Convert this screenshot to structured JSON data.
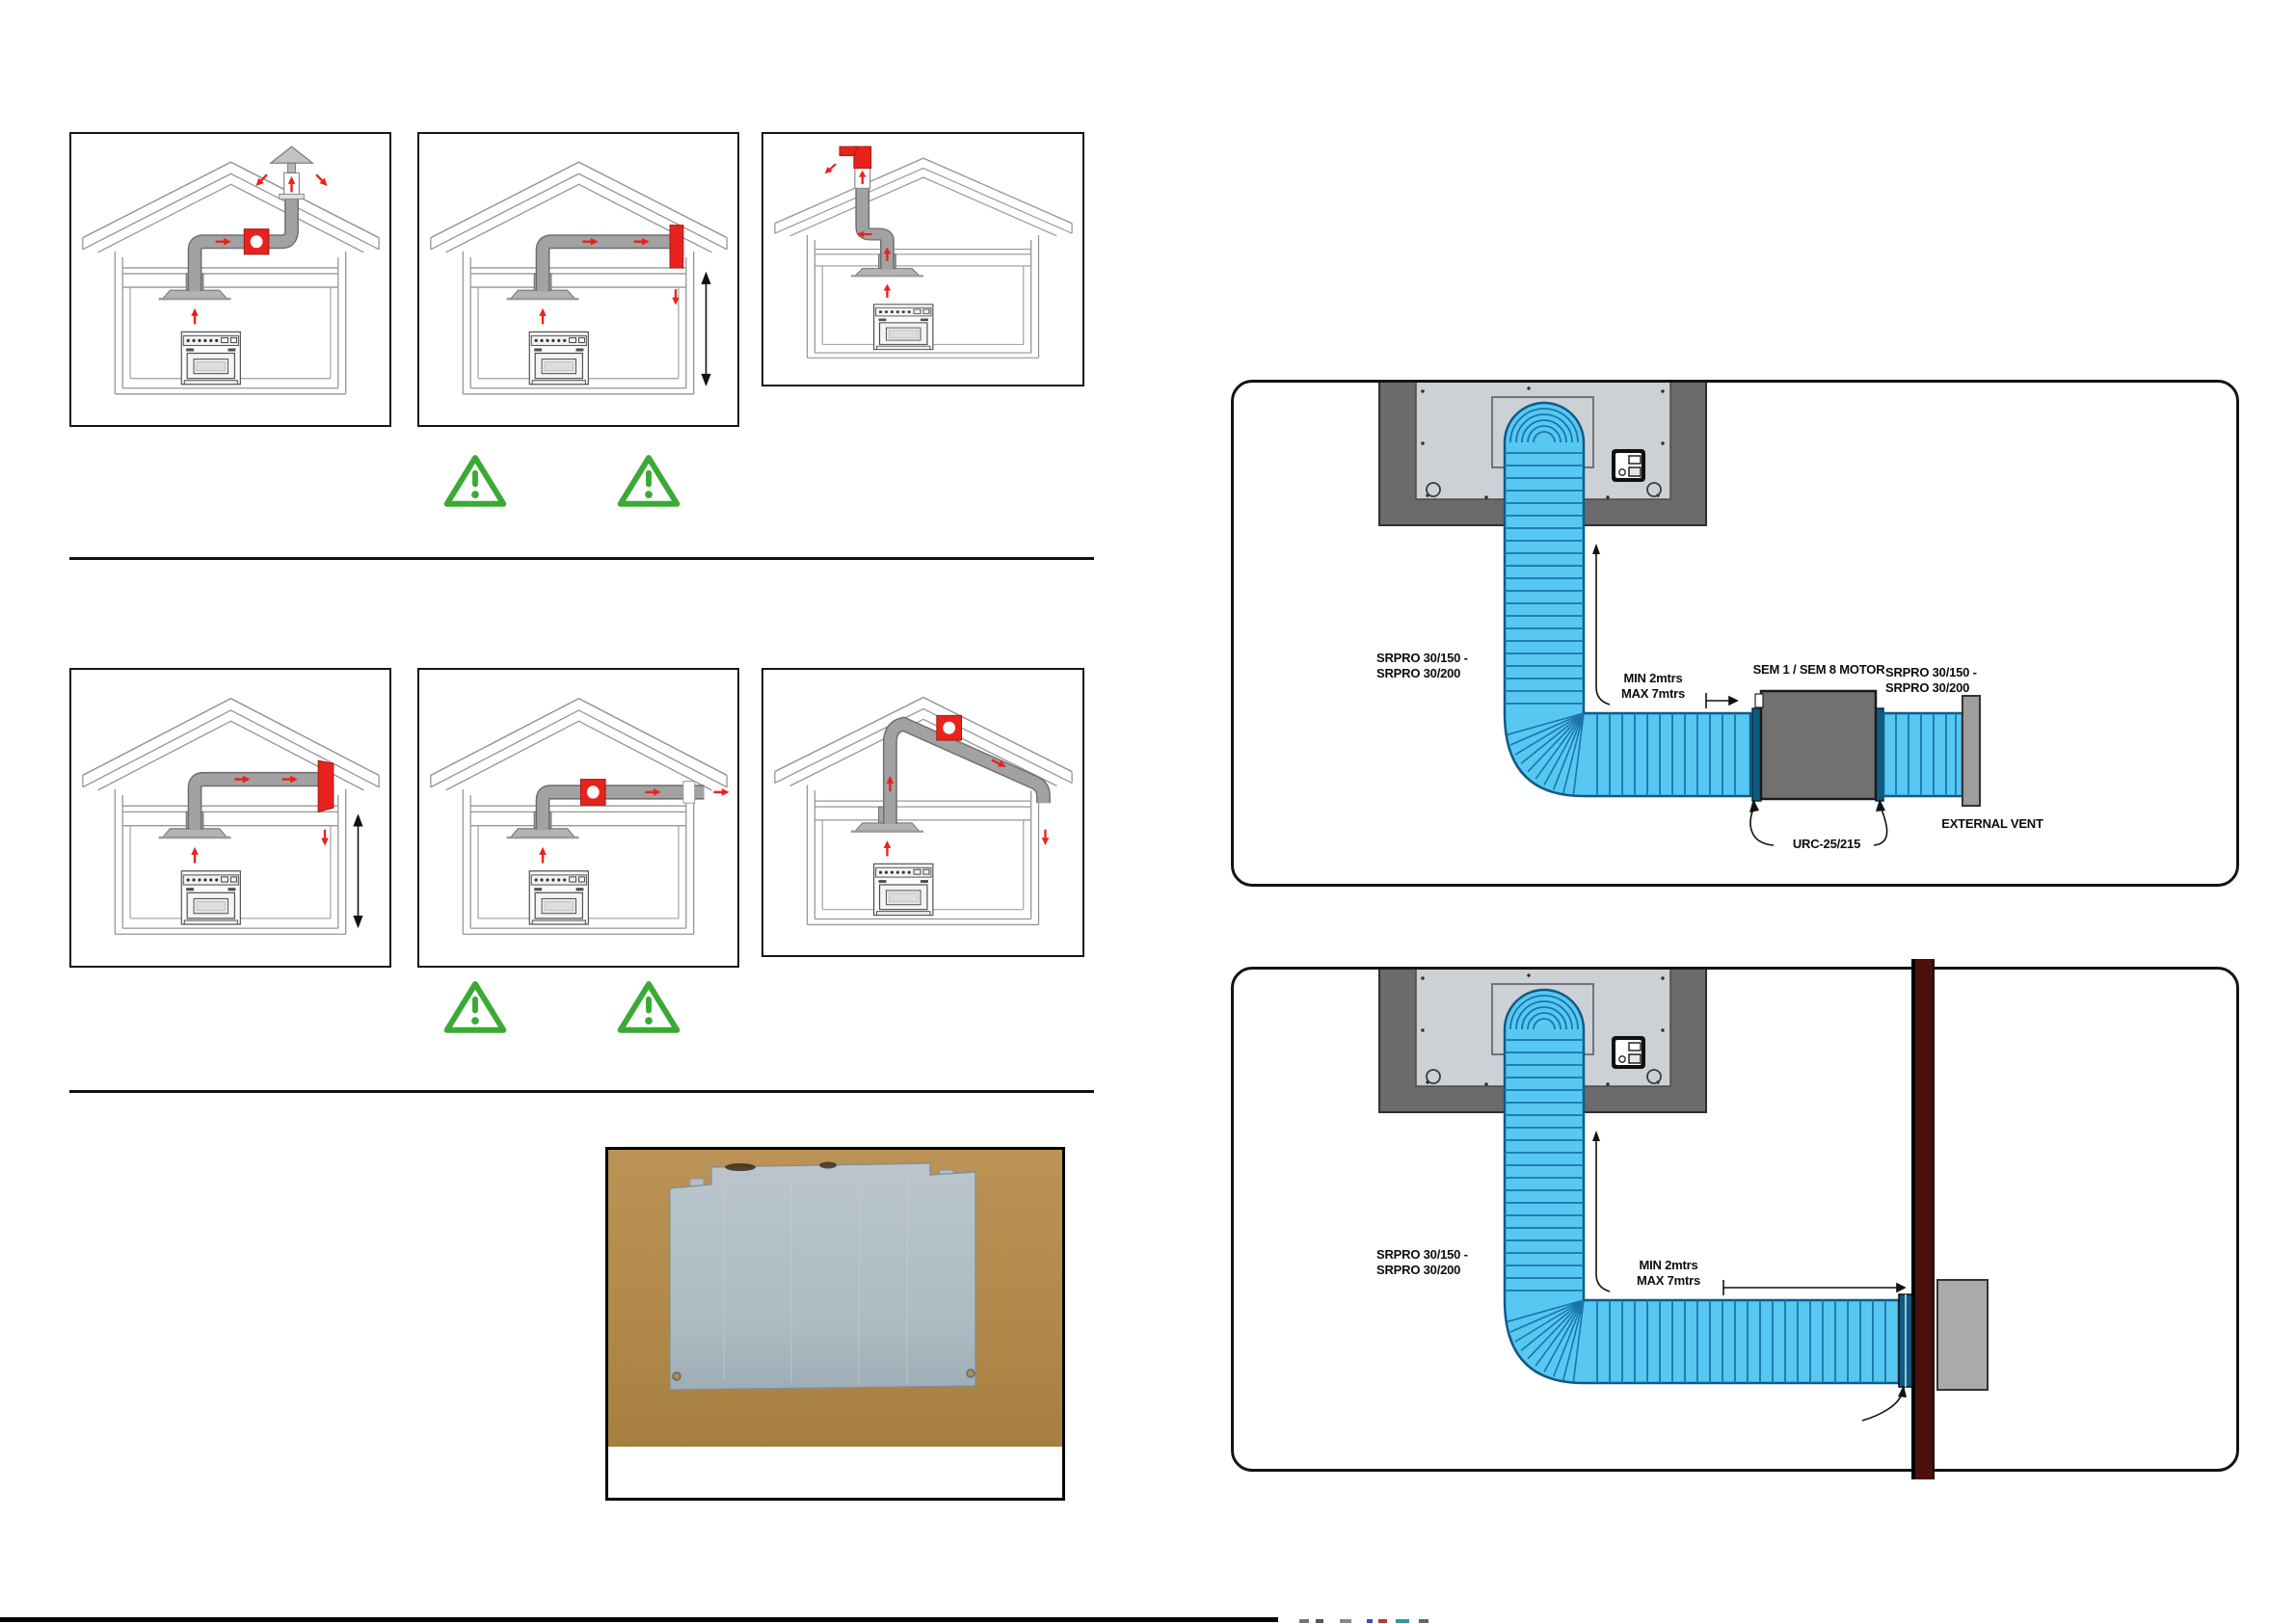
{
  "colors": {
    "accent_red": "#e8231d",
    "warning_green": "#3aaa35",
    "duct_blue": "#57c8f2",
    "duct_blue_rib": "#1a74ad",
    "duct_gray": "#a2a2a2",
    "motor_gray": "#717171",
    "wall_maroon": "#4a100e",
    "hood_panel_gray": "#ccd1d6",
    "hood_frame_gray": "#6b6b6b",
    "photo_background_tan": "#b28a4e",
    "plate_gray": "#b2bfc7"
  },
  "icons": {
    "warning": "warning-triangle-icon",
    "airflow": "red-arrow-icon",
    "measurement": "double-headed-arrow-icon"
  },
  "diagram_motor_inline": {
    "srpro_left_line1": "SRPRO 30/150 -",
    "srpro_left_line2": "SRPRO 30/200",
    "min_label": "MIN 2mtrs",
    "max_label": "MAX 7mtrs",
    "motor_label": "SEM 1 / SEM 8 MOTOR",
    "srpro_right_line1": "SRPRO 30/150 -",
    "srpro_right_line2": "SRPRO 30/200",
    "external_vent_label": "EXTERNAL VENT",
    "connector_label": "URC-25/215"
  },
  "diagram_wall_vent": {
    "srpro_left_line1": "SRPRO 30/150 -",
    "srpro_left_line2": "SRPRO 30/200",
    "min_label": "MIN 2mtrs",
    "max_label": "MAX 7mtrs"
  }
}
